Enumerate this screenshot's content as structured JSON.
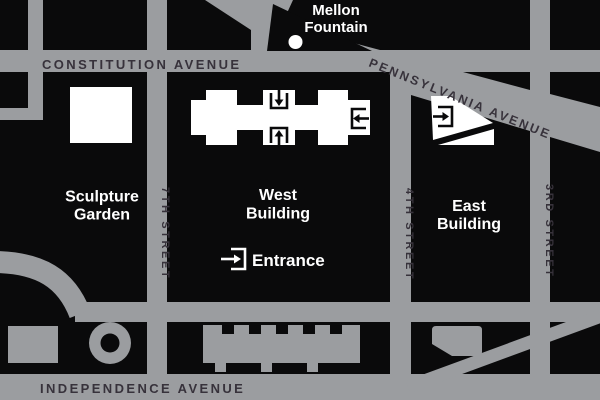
{
  "avenues": {
    "constitution": "CONSTITUTION AVENUE",
    "pennsylvania": "PENNSYLVANIA AVENUE",
    "independence": "INDEPENDENCE AVENUE"
  },
  "streets": {
    "seventh": "7TH STREET",
    "fourth": "4TH STREET",
    "third": "3RD STREET"
  },
  "labels": {
    "mellon_fountain_line1": "Mellon",
    "mellon_fountain_line2": "Fountain",
    "sculpture_garden_line1": "Sculpture",
    "sculpture_garden_line2": "Garden",
    "west_building_line1": "West",
    "west_building_line2": "Building",
    "east_building_line1": "East",
    "east_building_line2": "Building",
    "entrance": "Entrance"
  },
  "colors": {
    "street_gray": "#9b9da0",
    "block_black": "#0a0a0b",
    "text_dark": "#37323b",
    "text_light": "#ffffff"
  }
}
